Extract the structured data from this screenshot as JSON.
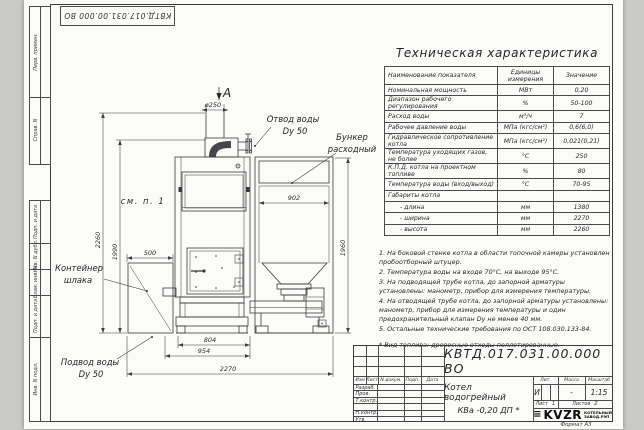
{
  "style": {
    "line_color": "#3a3a40",
    "sheet_color": "#fbfbf8",
    "logo_color": "#0d0d0d"
  },
  "frame": {
    "top_stamp": "КВТД.017.031.00.000  ВО",
    "format_label": "Формат А3",
    "columns": {
      "perv": "Перв. примен.",
      "sprav": "Справ. N",
      "podp1": "Подп. и дата",
      "inv_dubl": "Инв. N дубл.",
      "vzam": "Взам. инв. N",
      "podp2": "Подп. и дата",
      "inv_podl": "Инв. N подл."
    }
  },
  "drawing": {
    "view_arrow": "А",
    "labels": {
      "otvod_1": "Отвод воды",
      "otvod_2": "Dy 50",
      "bunker_1": "Бункер",
      "bunker_2": "расходный",
      "see_note": "см. п. 1",
      "container_1": "Контейнер",
      "container_2": "шлака",
      "podvod_1": "Подвод воды",
      "podvod_2": "Dy 50"
    },
    "dims": {
      "chimney": "ø250",
      "h500": "500",
      "h902": "902",
      "h804": "804",
      "h954": "954",
      "h2270": "2270",
      "v2260": "2260",
      "v1990": "1990",
      "v1960": "1960"
    }
  },
  "tech": {
    "title": "Техническая характеристика",
    "col_name": "Наименование показателя",
    "col_units": "Единицы измерения",
    "col_value": "Значение",
    "rows": [
      {
        "name": "Номинальная мощность",
        "units": "МВт",
        "value": "0,20"
      },
      {
        "name": "Диапазон рабочего регулирования",
        "units": "%",
        "value": "50-100"
      },
      {
        "name": "Расход воды",
        "units": "м³/ч",
        "value": "7"
      },
      {
        "name": "Рабочее давление воды",
        "units": "МПа (кгс/см²)",
        "value": "0,6(6,0)"
      },
      {
        "name": "Гидравлическое сопротивление котла",
        "units": "МПа (кгс/см²)",
        "value": "0,021(0,21)"
      },
      {
        "name": "Температура уходящих газов, не более",
        "units": "°С",
        "value": "250"
      },
      {
        "name": "К.П.Д. котла на проектном топливе",
        "units": "%",
        "value": "80"
      },
      {
        "name": "Температура воды (вход/выход)",
        "units": "°С",
        "value": "70-95"
      },
      {
        "name": "Габариты котла",
        "units": "",
        "value": ""
      },
      {
        "name": "- длина",
        "units": "мм",
        "value": "1380"
      },
      {
        "name": "- ширина",
        "units": "мм",
        "value": "2270"
      },
      {
        "name": "- высота",
        "units": "мм",
        "value": "2260"
      }
    ]
  },
  "notes": [
    "1. На боковой стенке котла в области топочной камеры установлен пробоотборный штуцер.",
    "2. Температура воды на входе 70°С, на выходе 95°С.",
    "3. На подводящей трубе котла, до запорной арматуры установлены: манометр, прибор для измерения температуры.",
    "4. На отводящей трубе котла, до запорной арматуры установлены: манометр, прибор для измерения температуры и один предохранительный клапан Dу не менее 40 мм.",
    "5. Остальные технические требования по ОСТ 108.030.133-84."
  ],
  "fuel_note": "* Вид топлива: древесные отходы пеллетированные.",
  "title_block": {
    "doc_number": "КВТД.017.031.00.000  ВО",
    "name_line1": "Котел водогрейный",
    "name_line2": "КВа -0,20  ДП *",
    "rev_headers": {
      "izm": "Изм",
      "list": "Лист",
      "doc": "N докум.",
      "podp": "Подп.",
      "data": "Дата"
    },
    "sign_rows": [
      "Разраб.",
      "Пров.",
      "Т.контр.",
      "",
      "Н.контр.",
      "Утв."
    ],
    "lit_label": "Лит.",
    "lit_value": "И",
    "mass_label": "Масса",
    "mass_value": "-",
    "scale_label": "Масштаб",
    "scale_value": "1:15",
    "sheet_label": "Лист",
    "sheet_value": "1",
    "sheets_label": "Листов",
    "sheets_value": "2",
    "logo_mark": "≡",
    "logo_text": "KVZR",
    "logo_sub1": "КОТЕЛЬНЫЙ",
    "logo_sub2": "ЗАВОД.РЭП"
  }
}
